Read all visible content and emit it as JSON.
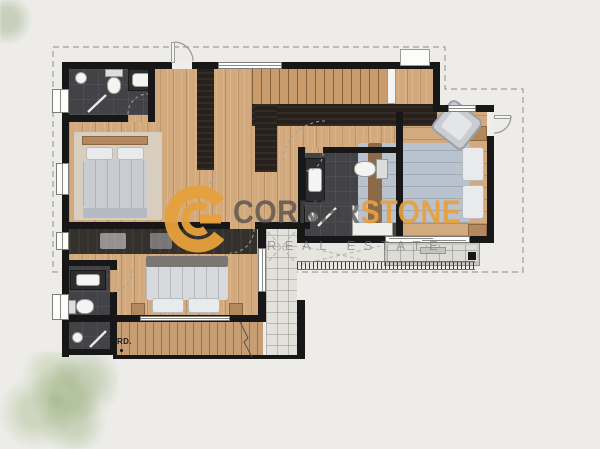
{
  "watermark": {
    "brand_primary": "CORNER",
    "brand_accent": "STONE",
    "tagline": "REAL ESTATE",
    "logo_icon": "cornerstone-c-logo"
  },
  "labels": {
    "roof_drain": "RD."
  },
  "palette": {
    "bg": "#edece8",
    "wall": "#171717",
    "wood": "#d3aa7d",
    "tile_dark": "#434347",
    "fixture": "#f4f4f2",
    "terrace": "#e2e1dc",
    "balcony": "#dcdbd5",
    "roof_band": "#c79e73",
    "stair": "#c89c6d",
    "stair_rail": "#28211b",
    "wardrobe": "#34302b",
    "bed_gray": "#c9cdd2",
    "bed_white": "#d7d9dc",
    "bed_blue": "#b9c2cf",
    "pillow": "#e8eaec",
    "rug": "#d8cec0",
    "tan": "#b3885d",
    "accent": "#e7a13c",
    "brand_gray": "#555555",
    "tagline_gray": "#90908c",
    "dash": "#9f9f99",
    "window": "#fdfdfc",
    "tree": "#a8bd8f"
  }
}
